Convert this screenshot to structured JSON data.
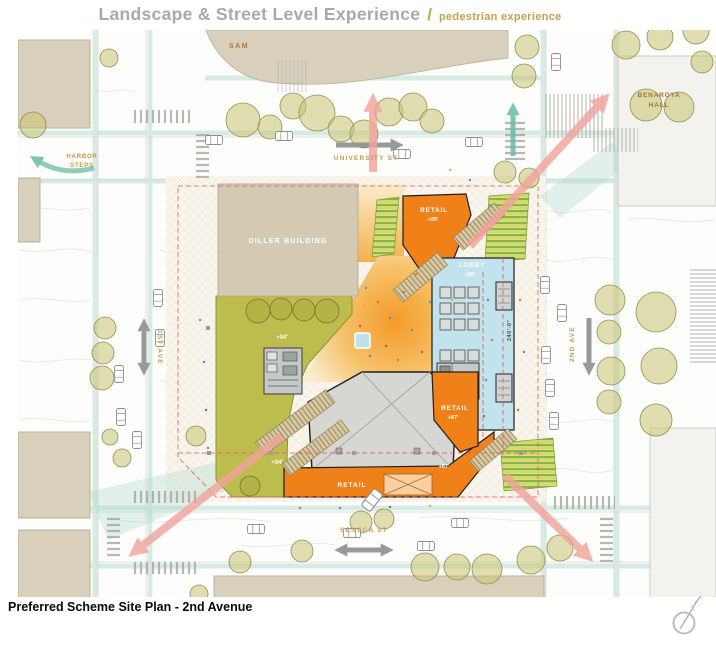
{
  "header": {
    "title": "Landscape & Street Level Experience",
    "separator": "/",
    "subtitle": "pedestrian experience"
  },
  "footer": {
    "caption": "Preferred Scheme Site Plan - 2nd Avenue"
  },
  "plan": {
    "buildings": {
      "sam": "SAM",
      "benaroya": [
        "BENAROYA",
        "HALL"
      ],
      "diller": "DILLER BUILDING",
      "harbor_steps": [
        "HARBOR",
        "STEPS"
      ]
    },
    "streets": {
      "university": "UNIVERSITY ST",
      "seneca": "SENECA ST",
      "first_ave": "1ST AVE",
      "second_ave": "2ND AVE"
    },
    "program": {
      "retail_top_label": "RETAIL",
      "retail_top_elev": "+89'",
      "lobby_label": "LOBBY",
      "lobby_elev": "+89'",
      "retail_right_label": "RETAIL",
      "retail_right_elev": "+87'",
      "retail_bottom_label": "RETAIL",
      "retail_bottom_elev": "+87'",
      "terrace_upper_elev": "+94'",
      "terrace_lower_elev": "+94'"
    },
    "dimension_240": "240'-0\"",
    "colors": {
      "retail_orange": "#f08119",
      "terrace_olive": "#bdbd4e",
      "lobby_blue": "#c2e3ee",
      "building_tan": "#d9d0bb",
      "flow_arrow_pink": "#f2a39b",
      "green_street_teal": "#6fbfa8",
      "street_label_gold": "#c49a58",
      "building_label_brown": "#ad6f35",
      "traffic_arrow_gray": "#8f8f8f",
      "property_line_red": "#d95f5f"
    },
    "icons": {
      "compass": "north-arrow"
    }
  }
}
